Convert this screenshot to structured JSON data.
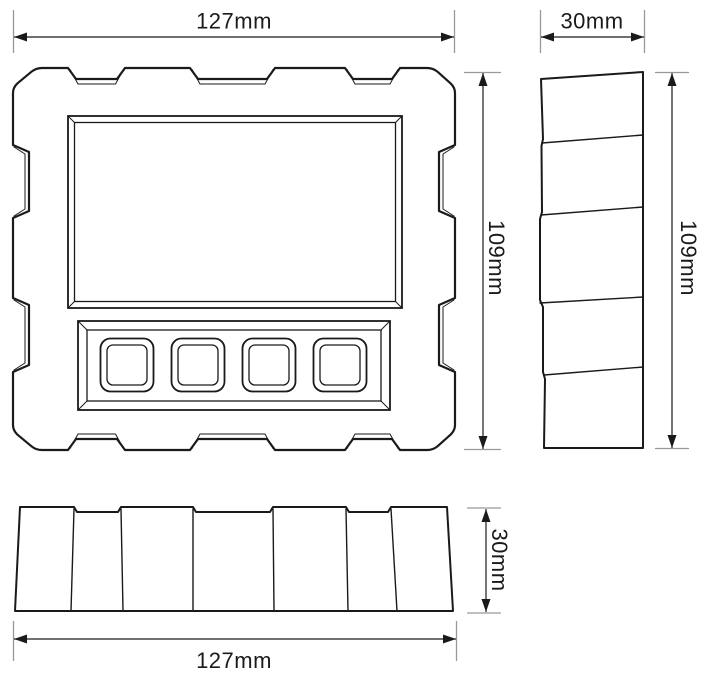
{
  "dimensions": {
    "front_width": "127mm",
    "side_width": "30mm",
    "front_height": "109mm",
    "side_height": "109mm",
    "bottom_height": "30mm",
    "bottom_width": "127mm"
  },
  "views": {
    "front": {
      "buttons": 4,
      "screens": 1
    },
    "side": {
      "segments": 5
    },
    "bottom": {
      "segments": 7
    }
  },
  "colors": {
    "line": "#1a1a1a",
    "extension_line": "#999999",
    "background": "#ffffff"
  }
}
